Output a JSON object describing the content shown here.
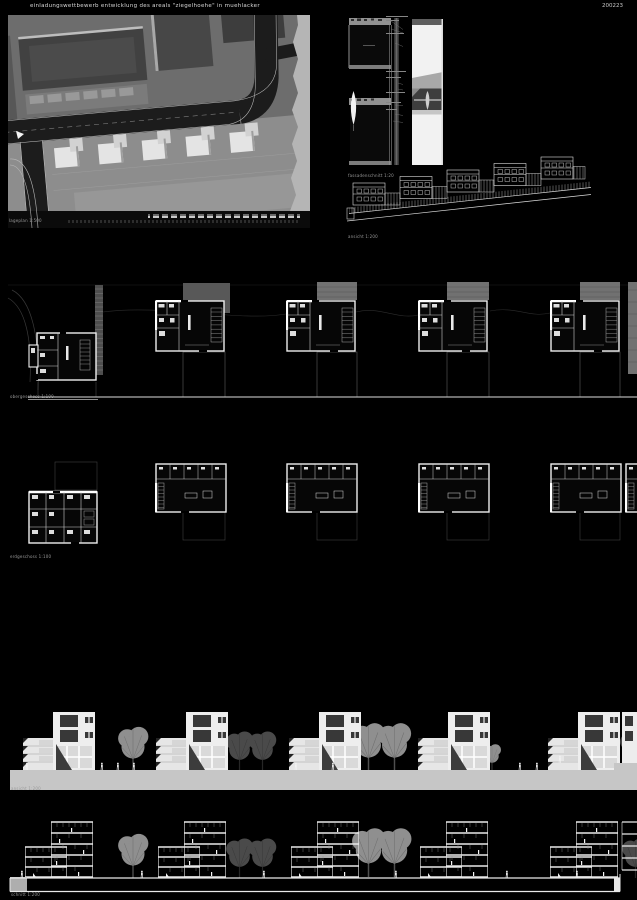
{
  "header": {
    "title": "einladungswettbewerb entwicklung des areals \"ziegelhoehe\" in muehlacker",
    "code": "200223"
  },
  "labels": {
    "site_plan": "lageplan 1:500",
    "facade_detail": "fassadenschnitt 1:20",
    "street_row": "ansicht 1:200",
    "upper_plans": "obergeschoss 1:100",
    "ground_plans": "erdgeschoss 1:100",
    "elevation": "ansicht 1:200",
    "section": "schnitt 1:200"
  },
  "colors": {
    "background": "#000000",
    "line_white": "#e9e9e9",
    "ground_bar": "#c6c6c6",
    "building_light": "#ededed",
    "window_dark": "#383838",
    "tree_light": "#8f8f8f",
    "tree_dark": "#4a4a4a",
    "plan_hatch_gray": "#717171",
    "site_terrain": "#8d8d8d",
    "site_road": "#1c1c1c"
  }
}
